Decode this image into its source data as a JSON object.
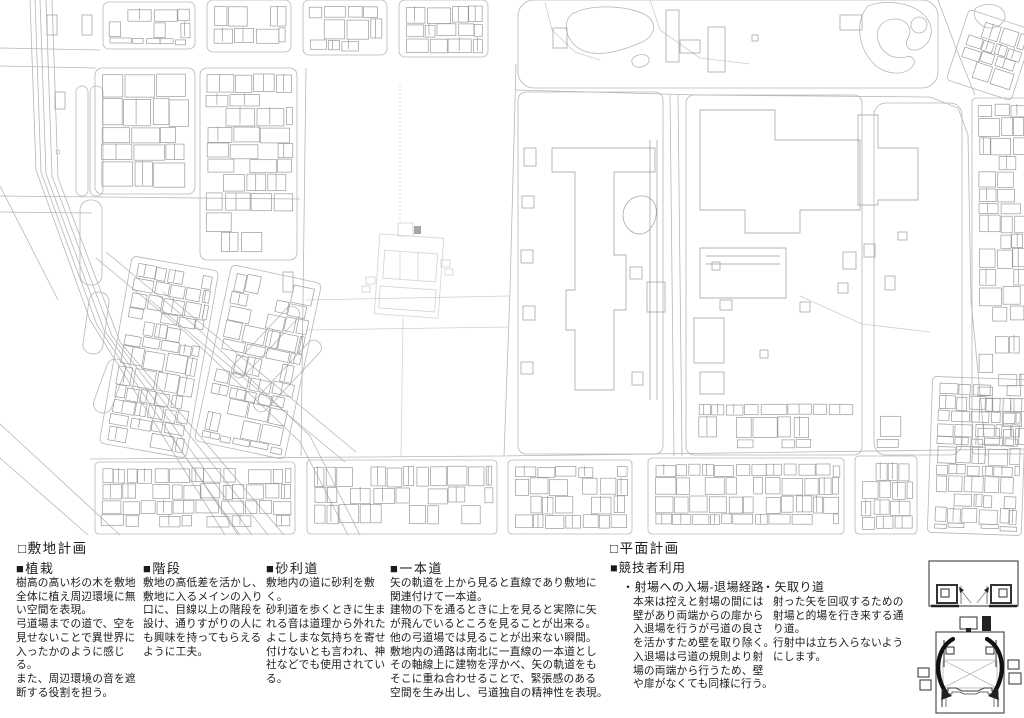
{
  "sections": {
    "site": {
      "title": "□敷地計画",
      "items": [
        {
          "heading": "■植栽",
          "body": "樹高の高い杉の木を敷地\n全体に植え周辺環境に無\nい空間を表現。\n弓道場までの道で、空を\n見せないことで異世界に\n入ったかのように感じる。\nまた、周辺環境の音を遮\n断する役割を担う。"
        },
        {
          "heading": "■階段",
          "body": "敷地の高低差を活かし、\n敷地に入るメインの入り\n口に、目線以上の階段を\n設け、通りすがりの人に\nも興味を持ってもらえる\nように工夫。"
        },
        {
          "heading": "■砂利道",
          "body": "敷地内の道に砂利を敷く。\n砂利道を歩くときに生ま\nれる音は道理から外れた\nよこしまな気持ちを寄せ\n付けないとも言われ、神\n社などでも使用されてい\nる。"
        },
        {
          "heading": "■一本道",
          "body": "矢の軌道を上から見ると直線であり敷地に\n関連付けて一本道。\n建物の下を通るときに上を見ると実際に矢\nが飛んでいるところを見ることが出来る。\n他の弓道場では見ることが出来ない瞬間。\n敷地内の通路は南北に一直線の一本道とし\nその軸線上に建物を浮かべ、矢の軌道をも\nそこに重ね合わせることで、緊張感のある\n空間を生み出し、弓道独自の精神性を表現。"
        }
      ]
    },
    "plan": {
      "title": "□平面計画",
      "subtitle": "■競技者利用",
      "items": [
        {
          "heading": "・射場への入場-退場経路",
          "body": "本来は控えと射場の間には\n壁があり両端からの扉から\n入退場を行うが弓道の良さ\nを活かすため壁を取り除く。\n入退場は弓道の規則より射\n場の両端から行うため、壁\nや扉がなくても同様に行う。"
        },
        {
          "heading": "・矢取り道",
          "body": "射った矢を回収するための\n射場と的場を行き来する通\nり道。\n行射中は立ち入らないよう\nにします。"
        }
      ]
    }
  },
  "map": {
    "colors": {
      "line": "#9b9b9b",
      "road": "#b6b6b6",
      "faint": "#cfcfcf",
      "ghost": "#d8d8d8",
      "dark": "#a6a6a6",
      "ink": "#1b1b1b"
    },
    "shapes": [
      {
        "t": "pl",
        "c": "road",
        "p": [
          [
            30,
            0
          ],
          [
            36,
            170
          ],
          [
            90,
            320
          ],
          [
            225,
            535
          ]
        ]
      },
      {
        "t": "pl",
        "c": "road",
        "p": [
          [
            35,
            0
          ],
          [
            41,
            172
          ],
          [
            97,
            325
          ],
          [
            238,
            535
          ]
        ]
      },
      {
        "t": "pl",
        "c": "road",
        "p": [
          [
            40,
            0
          ],
          [
            46,
            174
          ],
          [
            104,
            330
          ],
          [
            252,
            535
          ]
        ]
      },
      {
        "t": "pl",
        "c": "road",
        "p": [
          [
            46,
            0
          ],
          [
            52,
            176
          ],
          [
            112,
            336
          ],
          [
            268,
            535
          ]
        ]
      },
      {
        "t": "pl",
        "c": "road",
        "p": [
          [
            52,
            0
          ],
          [
            58,
            178
          ],
          [
            120,
            342
          ],
          [
            284,
            535
          ]
        ]
      },
      {
        "t": "pl",
        "c": "road",
        "p": [
          [
            0,
            186
          ],
          [
            58,
            300
          ]
        ]
      },
      {
        "t": "pl",
        "c": "road",
        "p": [
          [
            0,
            424
          ],
          [
            120,
            535
          ]
        ]
      },
      {
        "t": "pl",
        "c": "road",
        "p": [
          [
            0,
            458
          ],
          [
            88,
            535
          ]
        ]
      },
      {
        "t": "pl",
        "c": "road",
        "p": [
          [
            168,
            432
          ],
          [
            240,
            535
          ]
        ]
      },
      {
        "t": "pl",
        "c": "road",
        "p": [
          [
            150,
            300
          ],
          [
            345,
            462
          ]
        ]
      },
      {
        "t": "pl",
        "c": "road",
        "p": [
          [
            163,
            292
          ],
          [
            356,
            452
          ]
        ]
      },
      {
        "t": "pl",
        "c": "road",
        "p": [
          [
            0,
            48
          ],
          [
            100,
            50
          ]
        ]
      },
      {
        "t": "pl",
        "c": "road",
        "p": [
          [
            0,
            66
          ],
          [
            96,
            68
          ]
        ]
      },
      {
        "t": "pl",
        "c": "road",
        "p": [
          [
            0,
            196
          ],
          [
            300,
            199
          ]
        ]
      },
      {
        "t": "pl",
        "c": "road",
        "p": [
          [
            0,
            212
          ],
          [
            92,
            213
          ]
        ]
      },
      {
        "t": "pl",
        "c": "road",
        "p": [
          [
            306,
            68
          ],
          [
            301,
            456
          ]
        ]
      },
      {
        "t": "pl",
        "c": "road",
        "p": [
          [
            516,
            64
          ],
          [
            510,
            290
          ],
          [
            504,
            456
          ]
        ]
      },
      {
        "t": "pl",
        "c": "road",
        "p": [
          [
            516,
            90
          ],
          [
            700,
            95
          ],
          [
            930,
            97
          ],
          [
            958,
            108
          ],
          [
            968,
            135
          ],
          [
            971,
            300
          ],
          [
            986,
            456
          ]
        ]
      },
      {
        "t": "pl",
        "c": "road",
        "p": [
          [
            670,
            95
          ],
          [
            674,
            456
          ]
        ]
      },
      {
        "t": "pl",
        "c": "road",
        "p": [
          [
            678,
            95
          ],
          [
            682,
            456
          ]
        ]
      },
      {
        "t": "pl",
        "c": "road",
        "p": [
          [
            90,
            459
          ],
          [
            500,
            456
          ],
          [
            1024,
            449
          ]
        ]
      },
      {
        "t": "pl",
        "c": "road",
        "p": [
          [
            96,
            258
          ],
          [
            185,
            332
          ],
          [
            300,
            442
          ],
          [
            348,
            535
          ]
        ]
      },
      {
        "t": "pl",
        "c": "road",
        "p": [
          [
            106,
            252
          ],
          [
            195,
            326
          ],
          [
            310,
            436
          ],
          [
            360,
            535
          ]
        ]
      },
      {
        "t": "pl",
        "c": "road",
        "p": [
          [
            938,
            0
          ],
          [
            956,
            48
          ],
          [
            975,
            95
          ]
        ]
      },
      {
        "t": "pl",
        "c": "faint",
        "p": [
          [
            800,
            296
          ],
          [
            862,
            324
          ],
          [
            930,
            332
          ]
        ]
      },
      {
        "t": "pl",
        "c": "faint",
        "p": [
          [
            306,
            300
          ],
          [
            510,
            296
          ]
        ]
      },
      {
        "t": "pl",
        "c": "faint",
        "p": [
          [
            306,
            330
          ],
          [
            508,
            327
          ]
        ]
      },
      {
        "t": "pa",
        "c": "bld",
        "d": "M552,148 L655,148 L655,172 L614,172 L614,255 L626,255 L626,310 L614,310 L614,390 L575,390 L575,330 L566,330 L566,290 L575,290 L575,172 L552,172 Z"
      },
      {
        "t": "pl",
        "c": "bld",
        "p": [
          [
            650,
            140
          ],
          [
            650,
            400
          ]
        ]
      },
      {
        "t": "pl",
        "c": "bld",
        "p": [
          [
            657,
            140
          ],
          [
            657,
            400
          ]
        ]
      },
      {
        "t": "pa",
        "c": "bld",
        "d": "M700,110 L775,110 L775,140 L860,140 L860,210 L800,210 L800,233 L745,233 L745,210 L700,210 Z"
      },
      {
        "t": "pa",
        "c": "bld",
        "d": "M700,248 h86 v50 h-86 Z M706,256 h74 M706,264 h74"
      },
      {
        "t": "pa",
        "c": "bld",
        "d": "M858,115 h20 v33 h40 v52 h-40 v5 h-20 Z"
      },
      {
        "t": "pa",
        "c": "bld",
        "d": "M630,200 c10,-8 24,-4 26,8 c2,12 -6,26 -16,26 c-10,0 -17,-10 -17,-18 c0,-8 3,-12 7,-16 Z"
      },
      {
        "t": "pa",
        "c": "road",
        "d": "M572,14 c18,-10 52,-9 72,0 c14,7 12,22 -2,28 c-20,9 -42,15 -58,9 c-16,-6 -24,-27 -12,-37 Z"
      },
      {
        "t": "pa",
        "c": "road",
        "d": "M868,6 c22,-8 50,-2 60,14 c8,13 0,28 -12,30 c-8,1 -12,-5 -8,-12 c5,-9 -1,-19 -13,-19 c-12,0 -20,9 -17,21 c3,13 15,20 28,17 c7,-2 11,4 6,10 c-9,10 -29,7 -39,-4 c-14,-15 -19,-41 -5,-57 Z"
      },
      {
        "t": "c",
        "c": "road",
        "cx": 919,
        "cy": 25,
        "r": 8
      },
      {
        "t": "pa",
        "c": "road",
        "d": "M634,57 c6,-4 14,-3 15,2 c1,5 -6,9 -12,8 c-5,-1 -7,-7 -3,-10 Z"
      },
      {
        "t": "pa",
        "c": "road",
        "d": "M976,8 c10,-6 24,-4 28,4 c4,8 -4,16 -14,16 c-10,0 -20,-12 -14,-20 Z"
      },
      {
        "t": "pl",
        "c": "faint",
        "p": [
          [
            545,
            2
          ],
          [
            552,
            30
          ],
          [
            575,
            52
          ],
          [
            600,
            60
          ]
        ]
      },
      {
        "t": "pl",
        "c": "faint",
        "p": [
          [
            650,
            0
          ],
          [
            660,
            30
          ],
          [
            700,
            58
          ],
          [
            750,
            64
          ]
        ]
      },
      {
        "t": "pl",
        "c": "ghost",
        "p": [
          [
            400,
            85
          ],
          [
            400,
            222
          ]
        ],
        "da": "2,2"
      },
      {
        "t": "pl",
        "c": "ghost",
        "p": [
          [
            403,
            318
          ],
          [
            401,
            458
          ]
        ]
      },
      {
        "t": "c",
        "c": "road",
        "cx": 58,
        "cy": 152,
        "r": 2
      },
      {
        "t": "rr",
        "c": "road",
        "r": [
          76,
          86,
          12,
          110
        ],
        "rx": 6
      },
      {
        "t": "rr",
        "c": "road",
        "r": [
          90,
          86,
          13,
          110
        ],
        "rx": 6
      },
      {
        "t": "rr",
        "c": "road",
        "r": [
          80,
          200,
          22,
          85
        ],
        "rx": 10
      },
      {
        "t": "rr",
        "c": "road",
        "r": [
          86,
          292,
          20,
          62
        ],
        "rx": 9,
        "rot": 8
      },
      {
        "t": "rr",
        "c": "road",
        "r": [
          100,
          358,
          19,
          56
        ],
        "rx": 9,
        "rot": 20
      },
      {
        "t": "rr",
        "c": "road",
        "r": [
          258,
          296,
          15,
          92
        ],
        "rx": 7,
        "rot": 43
      },
      {
        "t": "rr",
        "c": "road",
        "r": [
          280,
          330,
          15,
          92
        ],
        "rx": 7,
        "rot": 43
      },
      {
        "t": "rr",
        "c": "ghost",
        "r": [
          377,
          236,
          64,
          80
        ],
        "rot": 4,
        "cx": 409,
        "cy": 276
      },
      {
        "t": "rr",
        "c": "ghost",
        "r": [
          383,
          252,
          53,
          28
        ],
        "rot": 4,
        "cx": 409,
        "cy": 276
      },
      {
        "t": "rr",
        "c": "ghost",
        "r": [
          381,
          288,
          56,
          22
        ],
        "rot": 4,
        "cx": 409,
        "cy": 276
      },
      {
        "t": "pl",
        "c": "ghost",
        "p": [
          [
            400,
            252
          ],
          [
            400,
            280
          ]
        ]
      },
      {
        "t": "pl",
        "c": "ghost",
        "p": [
          [
            418,
            252
          ],
          [
            418,
            280
          ]
        ]
      },
      {
        "t": "rr",
        "c": "ghost",
        "r": [
          398,
          223,
          15,
          13
        ]
      },
      {
        "t": "rr",
        "c": "faint",
        "r": [
          366,
          277,
          9,
          7
        ]
      },
      {
        "t": "rr",
        "c": "faint",
        "r": [
          362,
          286,
          8,
          6
        ]
      },
      {
        "t": "rr",
        "c": "faint",
        "r": [
          441,
          260,
          9,
          7
        ]
      },
      {
        "t": "rr",
        "c": "faint",
        "r": [
          445,
          269,
          8,
          6
        ]
      },
      {
        "t": "rr",
        "c": "dark",
        "r": [
          414,
          226,
          7,
          8
        ]
      }
    ],
    "rects": [
      [
        666,
        10,
        13,
        52
      ],
      [
        680,
        40,
        20,
        13
      ],
      [
        708,
        27,
        17,
        45
      ],
      [
        752,
        35,
        6,
        6
      ],
      [
        840,
        15,
        22,
        15
      ],
      [
        553,
        28,
        14,
        20
      ],
      [
        524,
        148,
        12,
        18
      ],
      [
        522,
        196,
        12,
        12
      ],
      [
        521,
        250,
        12,
        13
      ],
      [
        523,
        306,
        12,
        14
      ],
      [
        521,
        362,
        12,
        12
      ],
      [
        630,
        267,
        12,
        12
      ],
      [
        647,
        282,
        18,
        30
      ],
      [
        632,
        372,
        11,
        13
      ],
      [
        694,
        318,
        30,
        45
      ],
      [
        700,
        372,
        24,
        22
      ],
      [
        760,
        350,
        8,
        8
      ],
      [
        800,
        302,
        10,
        10
      ],
      [
        843,
        252,
        13,
        17
      ],
      [
        838,
        283,
        10,
        10
      ],
      [
        720,
        300,
        12,
        10
      ],
      [
        898,
        232,
        9,
        8
      ],
      [
        864,
        244,
        11,
        13
      ],
      [
        712,
        262,
        8,
        8
      ],
      [
        885,
        276,
        10,
        14
      ],
      [
        47,
        15,
        10,
        20
      ],
      [
        82,
        15,
        10,
        20
      ],
      [
        55,
        92,
        10,
        17
      ],
      [
        283,
        272,
        10,
        20
      ]
    ],
    "blocks": [
      {
        "x": 103,
        "y": 2,
        "w": 92,
        "h": 47,
        "cw": 18,
        "ch": 15,
        "r": 6
      },
      {
        "x": 207,
        "y": 0,
        "w": 84,
        "h": 52,
        "cw": 17,
        "ch": 16,
        "r": 6
      },
      {
        "x": 303,
        "y": 0,
        "w": 84,
        "h": 55,
        "cw": 17,
        "ch": 16,
        "r": 6
      },
      {
        "x": 399,
        "y": 0,
        "w": 89,
        "h": 57,
        "cw": 18,
        "ch": 17,
        "r": 6
      },
      {
        "x": 95,
        "y": 68,
        "w": 100,
        "h": 126,
        "cw": 23,
        "ch": 21,
        "r": 7
      },
      {
        "x": 200,
        "y": 68,
        "w": 97,
        "h": 192,
        "cw": 22,
        "ch": 19,
        "r": 7
      },
      {
        "x": 115,
        "y": 262,
        "w": 88,
        "h": 190,
        "cw": 17,
        "ch": 15,
        "rot": 10,
        "r": 5
      },
      {
        "x": 212,
        "y": 272,
        "w": 92,
        "h": 180,
        "cw": 17,
        "ch": 15,
        "rot": 12,
        "r": 5
      },
      {
        "x": 518,
        "y": 0,
        "w": 420,
        "h": 88,
        "r": 16
      },
      {
        "x": 518,
        "y": 92,
        "w": 145,
        "h": 362,
        "r": 8
      },
      {
        "x": 686,
        "y": 95,
        "w": 176,
        "h": 360,
        "r": 8
      },
      {
        "x": 874,
        "y": 103,
        "w": 88,
        "h": 352,
        "r": 12
      },
      {
        "x": 972,
        "y": 98,
        "w": 58,
        "h": 356,
        "cw": 17,
        "ch": 15,
        "r": 4,
        "sk": 0.3
      },
      {
        "x": 956,
        "y": 18,
        "w": 68,
        "h": 74,
        "rot": 18,
        "cw": 17,
        "ch": 14,
        "r": 4
      },
      {
        "x": 95,
        "y": 462,
        "w": 200,
        "h": 72,
        "cw": 17,
        "ch": 15,
        "r": 4
      },
      {
        "x": 307,
        "y": 460,
        "w": 190,
        "h": 74,
        "cw": 16,
        "ch": 15,
        "r": 4
      },
      {
        "x": 508,
        "y": 460,
        "w": 124,
        "h": 74,
        "cw": 16,
        "ch": 14,
        "r": 4
      },
      {
        "x": 648,
        "y": 458,
        "w": 196,
        "h": 76,
        "cw": 16,
        "ch": 14,
        "r": 4
      },
      {
        "x": 855,
        "y": 456,
        "w": 62,
        "h": 78,
        "cw": 15,
        "ch": 14,
        "r": 4
      },
      {
        "x": 930,
        "y": 378,
        "w": 94,
        "h": 156,
        "cw": 15,
        "ch": 13,
        "rot": 2,
        "r": 4
      },
      {
        "x": 692,
        "y": 398,
        "w": 215,
        "h": 54,
        "cw": 20,
        "ch": 16,
        "sk": 0.45,
        "ol": 0
      }
    ]
  }
}
